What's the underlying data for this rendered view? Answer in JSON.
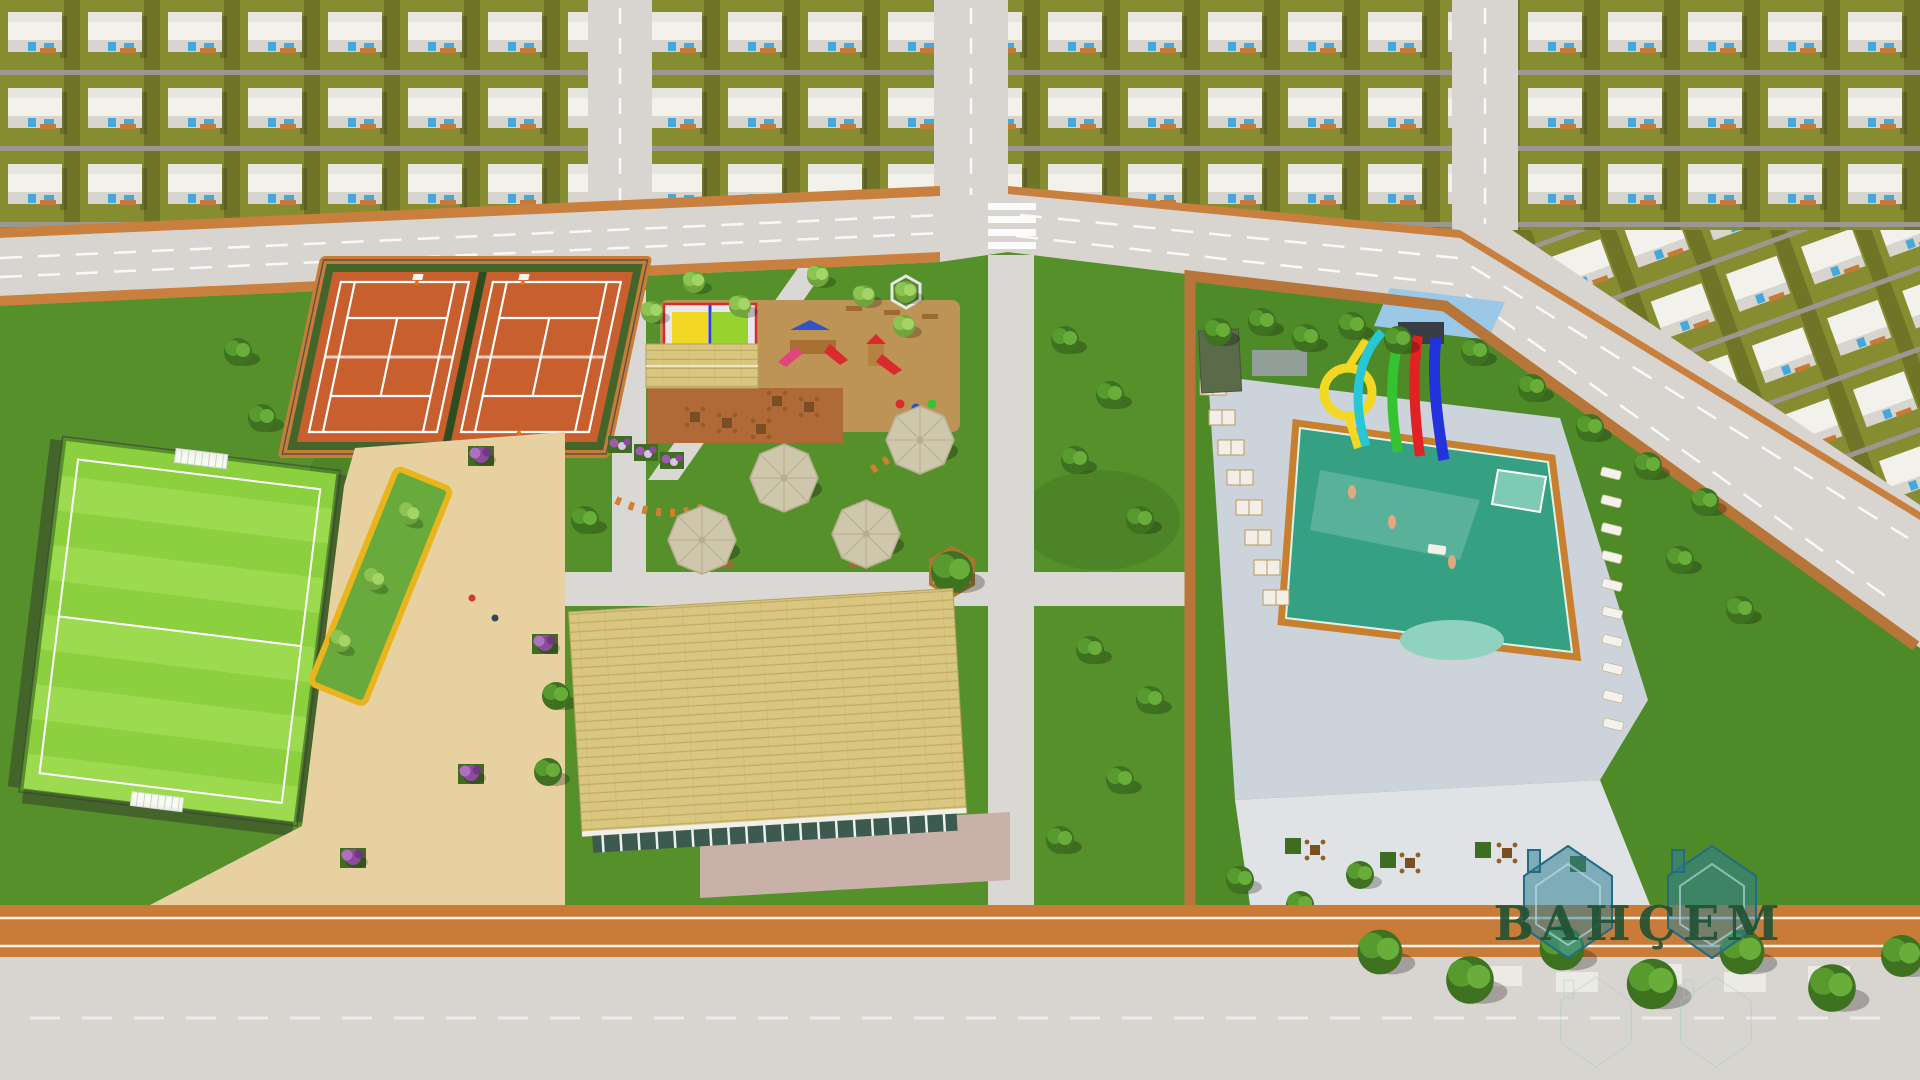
{
  "watermark": {
    "text": "BAHÇEM"
  },
  "palette": {
    "road": "#d8d5d1",
    "road_line": "#ffffff",
    "curb_orange": "#c9803f",
    "track": "#c97c38",
    "lawn": "#868c30",
    "lawn_dark": "#6f7526",
    "park_grass": "#55902b",
    "pitch": "#8ccf3f",
    "pitch_light": "#9cdb4f",
    "court_clay": "#c75f2e",
    "court_trim": "#2e4d1f",
    "hedge": "#44652a",
    "sand": "#e8d1a0",
    "pool_water": "#36a083",
    "pool_shallow": "#8fd3bf",
    "pool_deck": "#c8802f",
    "paving": "#ccd3da",
    "paving_light": "#e0e3e5",
    "wall": "#b8753a",
    "roof_shingle": "#d9c67f",
    "roof_line": "#bfab64",
    "house_wall": "#f3f1ec",
    "window_blue": "#45a8dc",
    "porch": "#c67a36",
    "wood": "#a8762f",
    "terrace_brick": "#b06a38",
    "slide_yellow": "#f2d824",
    "slide_cyan": "#28c7d8",
    "slide_green": "#35c431",
    "slide_red": "#e02222",
    "slide_blue": "#2233dd",
    "canopy": "#9cc8e8",
    "tree_dark": "#3e7120",
    "tree_mid": "#579a2d",
    "tree_light": "#69ad3a",
    "logo_teal": "#2e7f96",
    "logo_text": "#1f5132"
  }
}
